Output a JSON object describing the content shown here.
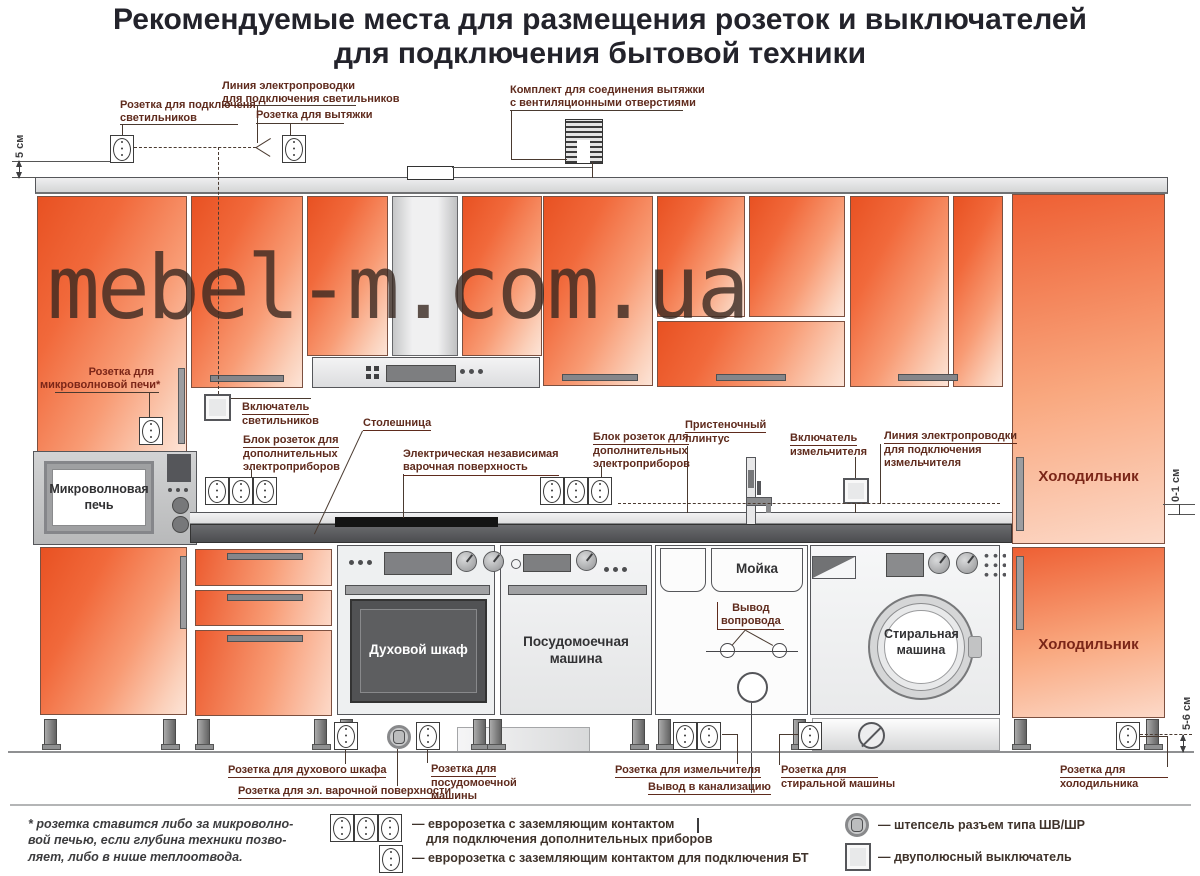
{
  "title": {
    "line1": "Рекомендуемые места для размещения розеток и выключателей",
    "line2": "для подключения бытовой техники"
  },
  "watermark": "mebel-m.com.ua",
  "dimensions": {
    "top": "5 см",
    "mid": "0-1 см",
    "bottom": "5-6 см"
  },
  "top_labels": {
    "lights_socket": {
      "l1": "Розетка для подключеня",
      "l2": "светильников"
    },
    "lights_wiring": {
      "l1": "Линия электропроводки",
      "l2": "для подключения светильников"
    },
    "hood_socket": "Розетка для вытяжки",
    "vent_kit": {
      "l1": "Комплект для соединения вытяжки",
      "l2": "с вентиляционными отверстиями"
    }
  },
  "mid_labels": {
    "lights_switch": {
      "l1": "Включатель",
      "l2": "светильников"
    },
    "socket_block": {
      "l1": "Блок розеток для",
      "l2": "дополнительных",
      "l3": "электроприборов"
    },
    "countertop": "Столешница",
    "cooktop": {
      "l1": "Электрическая независимая",
      "l2": "варочная поверхность"
    },
    "plinth": {
      "l1": "Пристеночный",
      "l2": "плинтус"
    },
    "grinder_switch": {
      "l1": "Включатель",
      "l2": "измельчителя"
    },
    "grinder_wiring": {
      "l1": "Линия электропроводки",
      "l2": "для подключения",
      "l3": "измельчителя"
    },
    "microwave_socket": {
      "l1": "Розетка для",
      "l2": "микроволновой печи*"
    },
    "water_outlet": {
      "l1": "Вывод",
      "l2": "вопровода"
    }
  },
  "appliances": {
    "microwave": {
      "l1": "Микроволновая",
      "l2": "печь"
    },
    "oven": "Духовой шкаф",
    "dishwasher": {
      "l1": "Посудомоечная",
      "l2": "машина"
    },
    "sink": "Мойка",
    "washer": {
      "l1": "Стиральная",
      "l2": "машина"
    },
    "fridge_upper": "Холодильник",
    "fridge_lower": "Холодильник"
  },
  "bottom_labels": {
    "oven_socket": "Розетка для духового шкафа",
    "cooktop_socket": "Розетка для эл. варочной поверхности",
    "dw_socket": {
      "l1": "Розетка для",
      "l2": "посудомоечной",
      "l3": "машины"
    },
    "grinder_socket": "Розетка для измельчителя",
    "sewer": "Вывод в канализацию",
    "washer_socket": {
      "l1": "Розетка для",
      "l2": "стиральной машины"
    },
    "fridge_socket": {
      "l1": "Розетка для",
      "l2": "холодильника"
    }
  },
  "footnote": {
    "l1": "* розетка ставится либо за микроволно-",
    "l2": "вой печью, если глубина техники позво-",
    "l3": "ляет, либо в нише теплоотвода."
  },
  "legend": {
    "euro_block": {
      "l1": "— евророзетка с заземляющим контактом",
      "l2": "для подключения дополнительных приборов"
    },
    "euro_single": "— евророзетка с заземляющим контактом для подключения БТ",
    "plug": "— штепсель разъем типа ШВ/ШР",
    "switch": "— двуполюсный выключатель"
  },
  "icons": {
    "socket": "euro-socket-icon",
    "socket_block": "triple-socket-icon",
    "plug": "shv-shr-plug-icon",
    "switch": "two-pole-switch-icon",
    "vent_kit": "vent-duct-icon",
    "water": "water-outlet-icon",
    "sewer": "sewer-outlet-icon"
  },
  "colors": {
    "door_orange": "#e85122",
    "door_pale": "#fce4d7",
    "label": "#5f2b1d",
    "countertop": "#56575a",
    "title": "#23232b"
  }
}
